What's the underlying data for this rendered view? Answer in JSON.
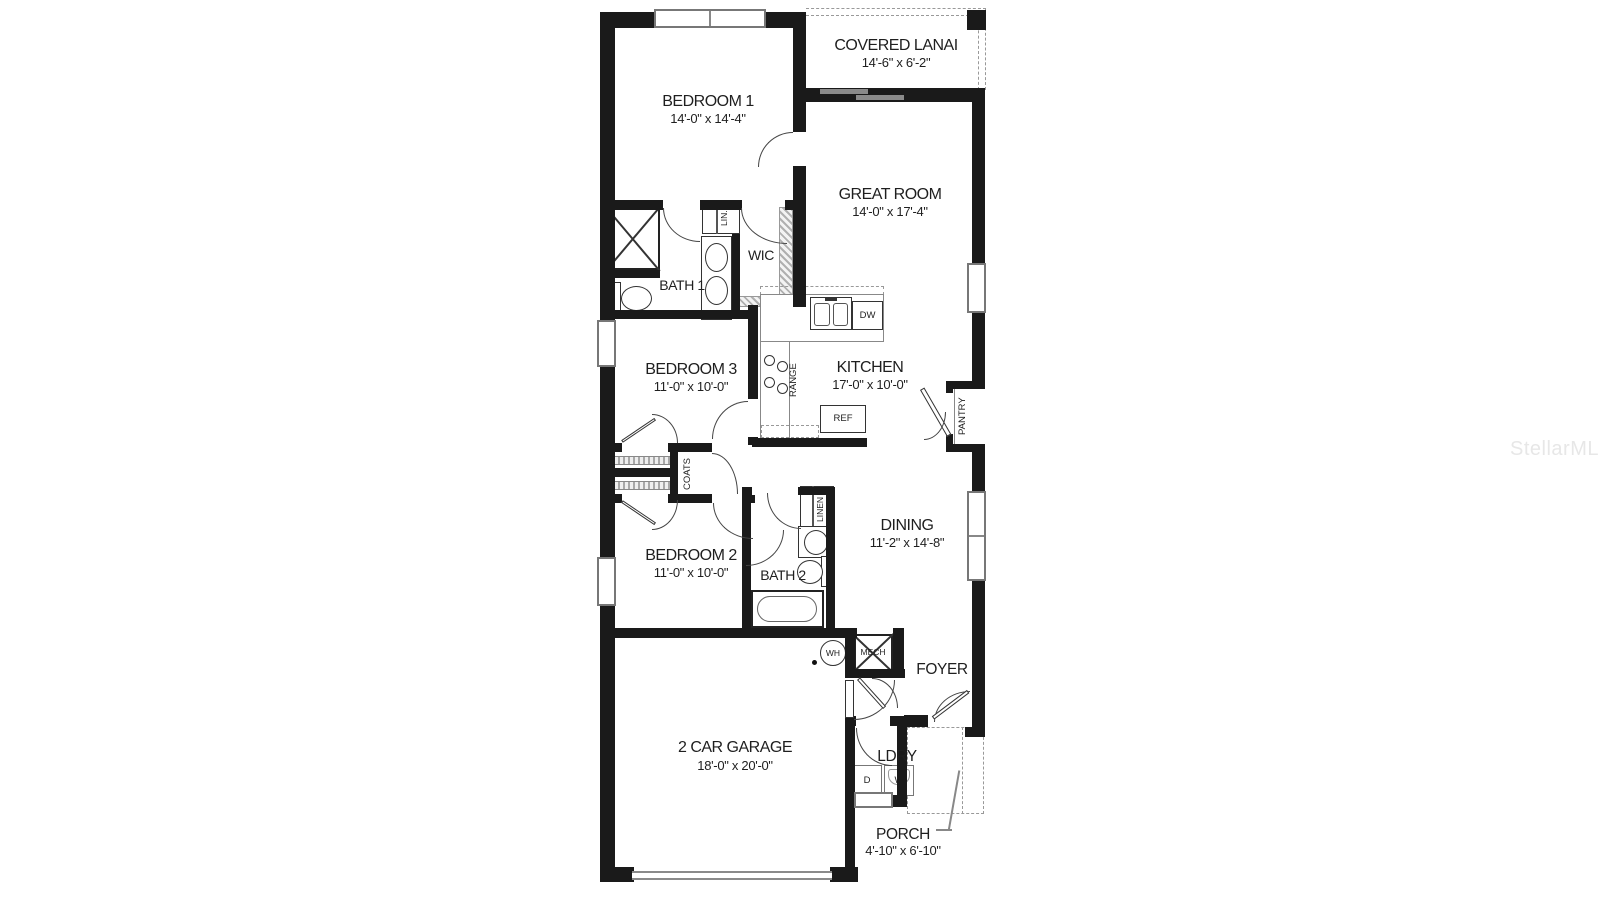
{
  "watermark": "StellarMLS",
  "rooms": {
    "covered_lanai": {
      "name": "COVERED LANAI",
      "dims": "14'-6\" x 6'-2\""
    },
    "bedroom1": {
      "name": "BEDROOM 1",
      "dims": "14'-0\" x 14'-4\""
    },
    "great_room": {
      "name": "GREAT ROOM",
      "dims": "14'-0\" x 17'-4\""
    },
    "bath1": {
      "name": "BATH 1"
    },
    "wic": {
      "name": "WIC"
    },
    "lin": {
      "name": "LIN."
    },
    "bedroom3": {
      "name": "BEDROOM 3",
      "dims": "11'-0\" x 10'-0\""
    },
    "kitchen": {
      "name": "KITCHEN",
      "dims": "17'-0\" x 10'-0\""
    },
    "pantry": {
      "name": "PANTRY"
    },
    "coats": {
      "name": "COATS"
    },
    "bedroom2": {
      "name": "BEDROOM 2",
      "dims": "11'-0\" x 10'-0\""
    },
    "bath2": {
      "name": "BATH 2"
    },
    "linen": {
      "name": "LINEN"
    },
    "dining": {
      "name": "DINING",
      "dims": "11'-2\" x 14'-8\""
    },
    "foyer": {
      "name": "FOYER"
    },
    "garage": {
      "name": "2 CAR GARAGE",
      "dims": "18'-0\" x 20'-0\""
    },
    "ldry": {
      "name": "LDRY"
    },
    "porch": {
      "name": "PORCH",
      "dims": "4'-10\" x 6'-10\""
    }
  },
  "labels": {
    "range": "RANGE",
    "dw": "DW",
    "ref": "REF",
    "wh": "WH",
    "mech": "MECH",
    "dryer": "D",
    "washer": "W"
  },
  "colors": {
    "wall": "#1a1a1a",
    "text": "#1f1f1f",
    "door_arc": "#444444",
    "hatch": "#999999",
    "glass": "#8a8a8a",
    "watermark": "#e7e7e7"
  }
}
